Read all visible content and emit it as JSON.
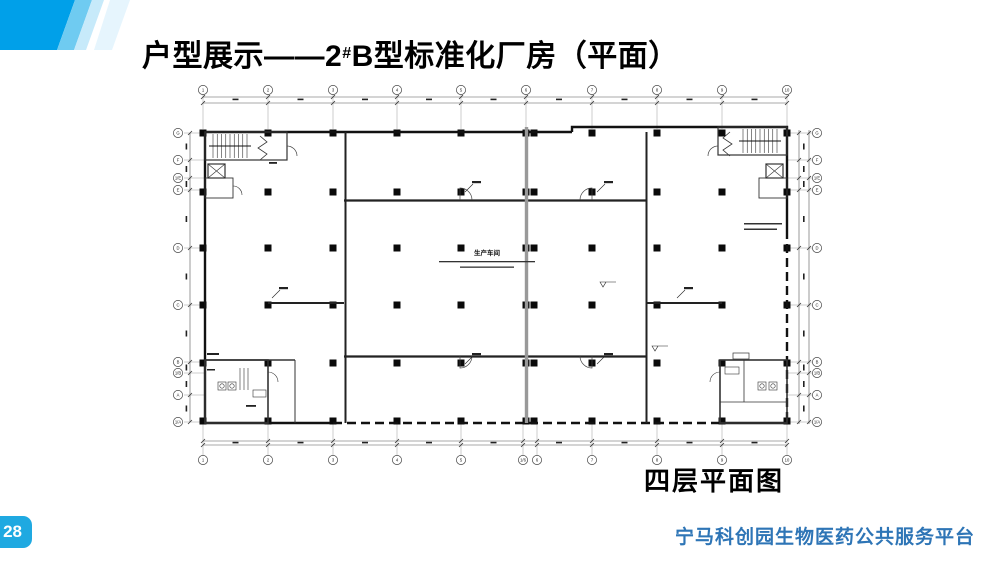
{
  "slide": {
    "title_prefix": "户型展示——2",
    "title_sup": "#",
    "title_suffix": "B型标准化厂房（平面）",
    "page_number": "28",
    "footer": "宁马科创园生物医药公共服务平台",
    "colors": {
      "accent": "#00A0E9",
      "stripe_mid": "#6FCBF1",
      "stripe_light": "#C7EAFA",
      "stripe_pale": "#E6F5FD",
      "badge_bg": "#1FA9E1",
      "footer_text": "#2E75B6",
      "line_dark": "#111111",
      "line_gray": "#999999"
    }
  },
  "plan": {
    "caption": "四层平面图",
    "room_label": "生产车间",
    "grid": {
      "top": [
        "1",
        "2",
        "3",
        "4",
        "5",
        "6",
        "7",
        "8",
        "9",
        "10"
      ],
      "bottom": [
        "1",
        "2",
        "3",
        "4",
        "5",
        "1/6",
        "6",
        "7",
        "8",
        "9",
        "10"
      ],
      "left": [
        "G",
        "F",
        "1/E",
        "E",
        "D",
        "C",
        "B",
        "1/B",
        "A",
        "1/A"
      ],
      "right": [
        "G",
        "F",
        "1/E",
        "E",
        "D",
        "C",
        "B",
        "1/B",
        "A",
        "1/A"
      ]
    }
  }
}
